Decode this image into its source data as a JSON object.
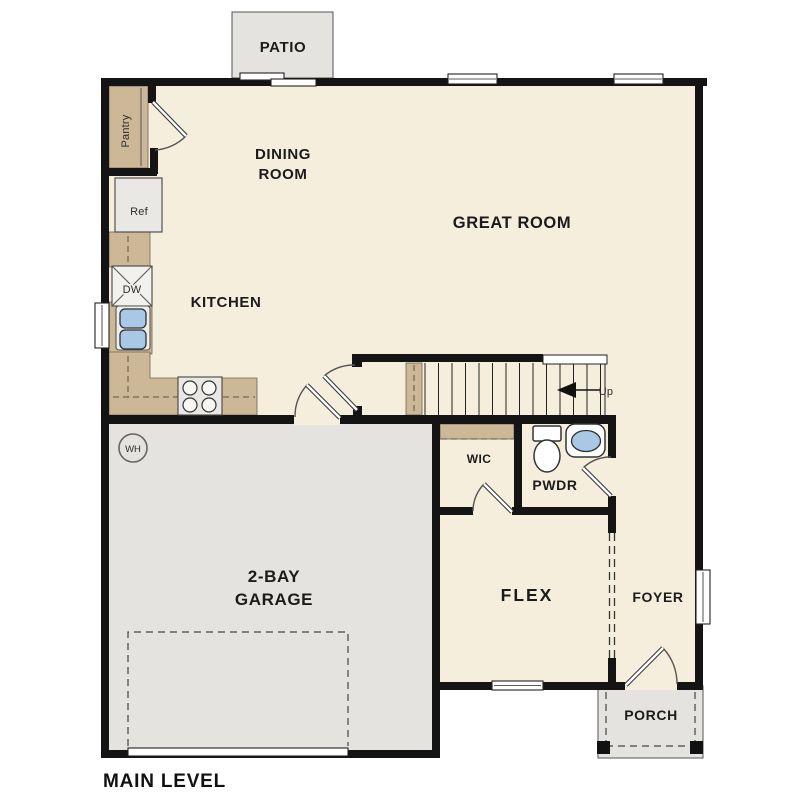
{
  "plan_title": "MAIN LEVEL",
  "rooms": {
    "patio": "PATIO",
    "dining_line1": "DINING",
    "dining_line2": "ROOM",
    "great_room": "GREAT ROOM",
    "kitchen": "KITCHEN",
    "garage_line1": "2-BAY",
    "garage_line2": "GARAGE",
    "wic": "WIC",
    "pwdr": "PWDR",
    "flex": "FLEX",
    "foyer": "FOYER",
    "porch": "PORCH"
  },
  "fixtures": {
    "pantry": "Pantry",
    "refrigerator": "Ref",
    "dishwasher": "DW",
    "water_heater": "WH",
    "stair_direction": "Up"
  },
  "colors": {
    "floor": "#f6eedd",
    "hard_surface": "#e4e3df",
    "cabinetry": "#ccb897",
    "sink_water": "#a9c8e6",
    "walls": "#141414",
    "text": "#1b1b1b"
  }
}
